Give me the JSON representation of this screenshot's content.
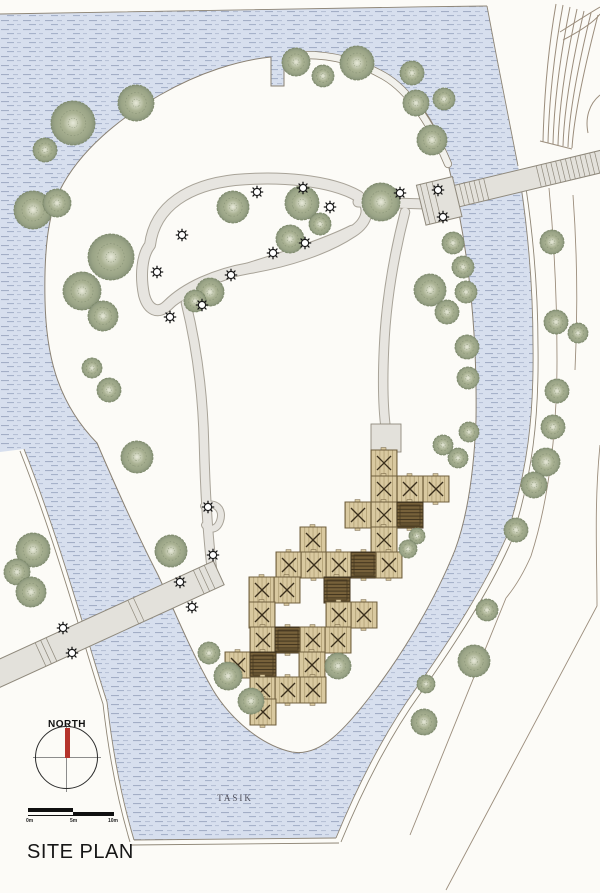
{
  "title": {
    "text": "SITE PLAN"
  },
  "labels": {
    "north": "NORTH",
    "lake": "TASIK"
  },
  "scalebar": {
    "ticks": [
      "0m",
      "5m",
      "10m"
    ]
  },
  "colors": {
    "page": "#fcfbf7",
    "water": "#d7dfee",
    "water_dash": "#9aa6c0",
    "bank": "#8e8575",
    "outline": "#8a8173",
    "path_fill": "#e7e5e0",
    "path_edge": "#a8a398",
    "shore_path_fill": "#f2f1ec",
    "deck": "#e3e1db",
    "deck_edge": "#8f897c",
    "tree_dark": "#7e8a6b",
    "tree_mid": "#aab293",
    "tree_light": "#e7e9d9",
    "tan": "#d9c9a0",
    "tan_line": "#b5a478",
    "tan_edge": "#6f5f3e",
    "x_mark": "#3a2f1c",
    "dark_module": "#77613a",
    "dark_module_line": "#43361f",
    "contour": "#9b8d7c",
    "lamp": "#161616",
    "needle_red": "#b5342c",
    "ink": "#161616"
  },
  "map": {
    "water_outer": "M0,14 C150,11 320,8 487,6 C497,60 509,120 518,166 C527,212 532,270 533,345 C534,415 528,470 506,538 C484,588 450,640 415,690 C390,725 362,775 336,838 L134,840 C122,795 113,755 107,702 C90,650 60,540 24,449 L0,452 Z",
    "site": "M449,168 C438,120 414,90 381,72 C352,57 320,52 286,56 L284,56 L284,86 L271,86 L271,57 C240,60 200,72 160,95 C120,118 80,150 60,190 C48,215 44,250 45,300 C46,350 55,400 97,443 C115,485 140,540 158,575 C172,605 190,650 213,690 C230,718 260,745 292,752 C320,757 345,730 375,690 C405,650 435,600 455,550 C468,515 474,470 476,420 C477,350 472,260 449,168 Z",
    "banks": [
      "M0,14 C150,11 320,8 487,6",
      "M487,6 C497,60 509,120 518,166",
      "M521,186 C529,240 533,290 533,345 C534,415 528,470 506,538 C484,588 450,640 415,690 C390,725 362,775 336,838",
      "M526,188 C534,242 538,292 538,347 C539,417 533,474 511,542 C489,592 455,644 420,694 C395,729 367,779 341,842",
      "M134,840 L336,838",
      "M131,845 L339,843",
      "M24,449 C60,540 90,650 107,702 C113,755 122,800 134,840",
      "M20,451 C56,542 86,652 103,704 C109,757 118,802 130,842"
    ],
    "contours": [
      "M549,188 C554,240 557,300 557,360 C557,430 549,500 531,556 C524,572 516,586 506,598",
      "M573,195 C577,250 578,310 575,370",
      "M506,598 L410,835",
      "M600,445 C594,505 597,556 597,606 L446,890"
    ],
    "road_fan": [
      "M556,4 C548,50 544,100 543,142",
      "M563,5 C554,53 549,103 548,143",
      "M570,7 C560,57 554,106 553,144",
      "M577,9 C566,60 559,109 558,145",
      "M584,11 C572,63 564,112 563,146",
      "M591,13 C578,66 569,115 568,147",
      "M598,15 C584,69 574,117 572,148",
      "M560,32 C574,23 588,14 600,7",
      "M563,40 C580,31 594,22 600,14",
      "M540,141 L572,149",
      "M600,95 C589,104 585,118 588,133"
    ],
    "walkways": [
      {
        "d": "M150,245 C155,205 190,185 235,180 C280,176 330,180 358,196 C372,206 368,222 352,232 C325,250 285,262 250,268 C215,274 185,288 168,305 C158,315 148,310 144,295 C140,275 142,255 150,245 Z",
        "w": 10
      },
      {
        "d": "M352,230 C320,246 272,260 228,274 C203,283 180,295 167,306",
        "w": 8.5
      },
      {
        "d": "M358,202 L426,204",
        "w": 9
      },
      {
        "d": "M405,212 C394,255 386,300 384,348 C382,392 384,416 386,430",
        "w": 8.5
      },
      {
        "d": "M186,303 C197,348 203,398 204,444 C205,486 207,532 213,578",
        "w": 8.5
      },
      {
        "d": "M204,506 C215,501 224,509 220,521 C217,530 209,531 205,525",
        "w": 6
      }
    ],
    "shore_path": {
      "d": "M288,56 C325,52 356,60 384,76 C410,91 432,126 448,164",
      "w": 6.5
    },
    "bridges": [
      {
        "x": 46,
        "y": 652,
        "angle": -24.6,
        "len": 265,
        "off": -75,
        "w": 26,
        "planks": [
          -6,
          0,
          6,
          96,
          102,
          168,
          174,
          180
        ],
        "platform": null
      },
      {
        "x": 424,
        "y": 204,
        "angle": -13.5,
        "len": 185,
        "off": 0,
        "w": 22,
        "planks": [
          4,
          9,
          14,
          19,
          24,
          29,
          34,
          39,
          44,
          49,
          54,
          59,
          64,
          118,
          123,
          128,
          133,
          138,
          143,
          148,
          153,
          158,
          163,
          168,
          173,
          178
        ],
        "platform": {
          "x": -3,
          "y": -20,
          "w": 37,
          "h": 41,
          "lines": [
            4,
            10,
            16
          ]
        }
      }
    ],
    "entry_platform": {
      "x": 371,
      "y": 424,
      "w": 30,
      "h": 28
    },
    "module_size": 26,
    "modules": [
      [
        384,
        463,
        0
      ],
      [
        384,
        489,
        0
      ],
      [
        410,
        489,
        0
      ],
      [
        436,
        489,
        0
      ],
      [
        358,
        515,
        0
      ],
      [
        384,
        515,
        0
      ],
      [
        410,
        515,
        1
      ],
      [
        313,
        540,
        0
      ],
      [
        384,
        540,
        0
      ],
      [
        289,
        565,
        0
      ],
      [
        314,
        565,
        0
      ],
      [
        339,
        565,
        0
      ],
      [
        364,
        565,
        1
      ],
      [
        389,
        565,
        0
      ],
      [
        262,
        590,
        0
      ],
      [
        287,
        590,
        0
      ],
      [
        337,
        590,
        1
      ],
      [
        262,
        615,
        0
      ],
      [
        339,
        615,
        0
      ],
      [
        364,
        615,
        0
      ],
      [
        263,
        640,
        0
      ],
      [
        288,
        640,
        1
      ],
      [
        313,
        640,
        0
      ],
      [
        338,
        640,
        0
      ],
      [
        238,
        665,
        0
      ],
      [
        263,
        665,
        1
      ],
      [
        312,
        665,
        0
      ],
      [
        263,
        690,
        0
      ],
      [
        288,
        690,
        0
      ],
      [
        313,
        690,
        0
      ],
      [
        263,
        712,
        0
      ]
    ],
    "trees": [
      [
        73,
        123,
        22
      ],
      [
        136,
        103,
        18
      ],
      [
        45,
        150,
        12
      ],
      [
        33,
        210,
        19
      ],
      [
        57,
        203,
        14
      ],
      [
        111,
        257,
        23
      ],
      [
        82,
        291,
        19
      ],
      [
        103,
        316,
        15
      ],
      [
        92,
        368,
        10
      ],
      [
        109,
        390,
        12
      ],
      [
        137,
        457,
        16
      ],
      [
        296,
        62,
        14
      ],
      [
        357,
        63,
        17
      ],
      [
        323,
        76,
        11
      ],
      [
        412,
        73,
        12
      ],
      [
        416,
        103,
        13
      ],
      [
        444,
        99,
        11
      ],
      [
        432,
        140,
        15
      ],
      [
        453,
        243,
        11
      ],
      [
        463,
        267,
        11
      ],
      [
        466,
        292,
        11
      ],
      [
        467,
        347,
        12
      ],
      [
        468,
        378,
        11
      ],
      [
        469,
        432,
        10
      ],
      [
        458,
        458,
        10
      ],
      [
        552,
        242,
        12
      ],
      [
        556,
        322,
        12
      ],
      [
        578,
        333,
        10
      ],
      [
        557,
        391,
        12
      ],
      [
        553,
        427,
        12
      ],
      [
        546,
        462,
        14
      ],
      [
        534,
        485,
        13
      ],
      [
        516,
        530,
        12
      ],
      [
        233,
        207,
        16
      ],
      [
        302,
        203,
        17
      ],
      [
        290,
        239,
        14
      ],
      [
        381,
        202,
        19
      ],
      [
        320,
        224,
        11
      ],
      [
        210,
        292,
        14
      ],
      [
        195,
        301,
        11
      ],
      [
        430,
        290,
        16
      ],
      [
        447,
        312,
        12
      ],
      [
        171,
        551,
        16
      ],
      [
        33,
        550,
        17
      ],
      [
        17,
        572,
        13
      ],
      [
        31,
        592,
        15
      ],
      [
        228,
        676,
        14
      ],
      [
        251,
        701,
        13
      ],
      [
        209,
        653,
        11
      ],
      [
        443,
        445,
        10
      ],
      [
        417,
        536,
        8
      ],
      [
        408,
        549,
        9
      ],
      [
        338,
        666,
        13
      ],
      [
        487,
        610,
        11
      ],
      [
        474,
        661,
        16
      ],
      [
        426,
        684,
        9
      ],
      [
        424,
        722,
        13
      ]
    ],
    "lamps": [
      [
        257,
        192
      ],
      [
        303,
        188
      ],
      [
        330,
        207
      ],
      [
        400,
        193
      ],
      [
        438,
        190
      ],
      [
        443,
        217
      ],
      [
        182,
        235
      ],
      [
        157,
        272
      ],
      [
        231,
        275
      ],
      [
        273,
        253
      ],
      [
        305,
        243
      ],
      [
        202,
        305
      ],
      [
        170,
        317
      ],
      [
        208,
        507
      ],
      [
        213,
        555
      ],
      [
        180,
        582
      ],
      [
        192,
        607
      ],
      [
        63,
        628
      ],
      [
        72,
        653
      ]
    ]
  }
}
